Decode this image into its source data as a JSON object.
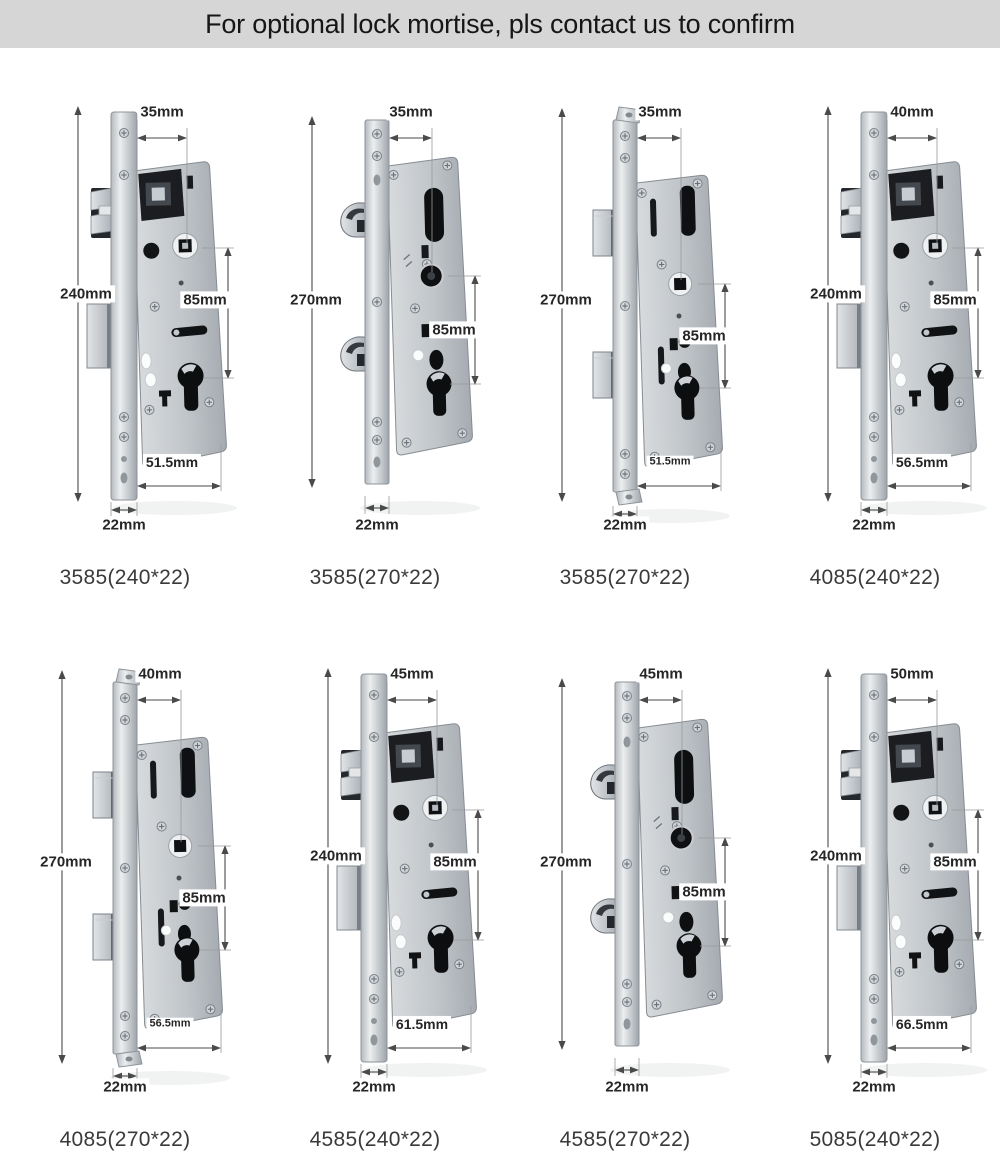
{
  "header": {
    "title": "For optional lock mortise, pls contact us to confirm"
  },
  "cells": [
    {
      "model": "3585(240*22)",
      "top_width": "35mm",
      "height": "240mm",
      "center_distance": "85mm",
      "edge_distance": "51.5mm",
      "plate_width": "22mm",
      "style": "latch-and-deadbolt"
    },
    {
      "model": "3585(270*22)",
      "top_width": "35mm",
      "height": "270mm",
      "center_distance": "85mm",
      "plate_width": "22mm",
      "style": "double-hook"
    },
    {
      "model": "3585(270*22)",
      "top_width": "35mm",
      "height": "270mm",
      "center_distance": "85mm",
      "edge_distance": "51.5mm",
      "plate_width": "22mm",
      "style": "double-block-end-tabs"
    },
    {
      "model": "4085(240*22)",
      "top_width": "40mm",
      "height": "240mm",
      "center_distance": "85mm",
      "edge_distance": "56.5mm",
      "plate_width": "22mm",
      "style": "latch-and-deadbolt"
    },
    {
      "model": "4085(270*22)",
      "top_width": "40mm",
      "height": "270mm",
      "center_distance": "85mm",
      "edge_distance": "56.5mm",
      "plate_width": "22mm",
      "style": "double-block-end-tabs"
    },
    {
      "model": "4585(240*22)",
      "top_width": "45mm",
      "height": "240mm",
      "center_distance": "85mm",
      "edge_distance": "61.5mm",
      "plate_width": "22mm",
      "style": "latch-and-deadbolt"
    },
    {
      "model": "4585(270*22)",
      "top_width": "45mm",
      "height": "270mm",
      "center_distance": "85mm",
      "plate_width": "22mm",
      "style": "double-hook"
    },
    {
      "model": "5085(240*22)",
      "top_width": "50mm",
      "height": "240mm",
      "center_distance": "85mm",
      "edge_distance": "66.5mm",
      "plate_width": "22mm",
      "style": "latch-and-deadbolt"
    }
  ],
  "colors": {
    "header_bg": "#d6d6d6",
    "header_text": "#161616",
    "steel_light": "#e9ebed",
    "steel_mid": "#bfc4c8",
    "steel_dark": "#9fa5ab",
    "cutout_black": "#0e1013",
    "dimension_line": "#4a4a4a",
    "label_text": "#262626",
    "caption_text": "#3a3a3a",
    "page_bg": "#ffffff"
  }
}
